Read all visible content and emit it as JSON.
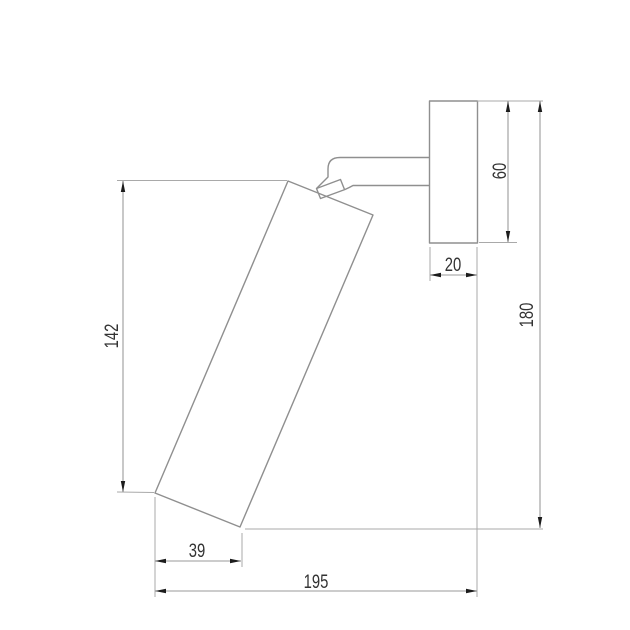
{
  "drawing": {
    "labels": {
      "body_height": "142",
      "mount_height": "60",
      "mount_depth": "20",
      "overall_height": "180",
      "body_width": "39",
      "overall_depth": "195"
    }
  }
}
